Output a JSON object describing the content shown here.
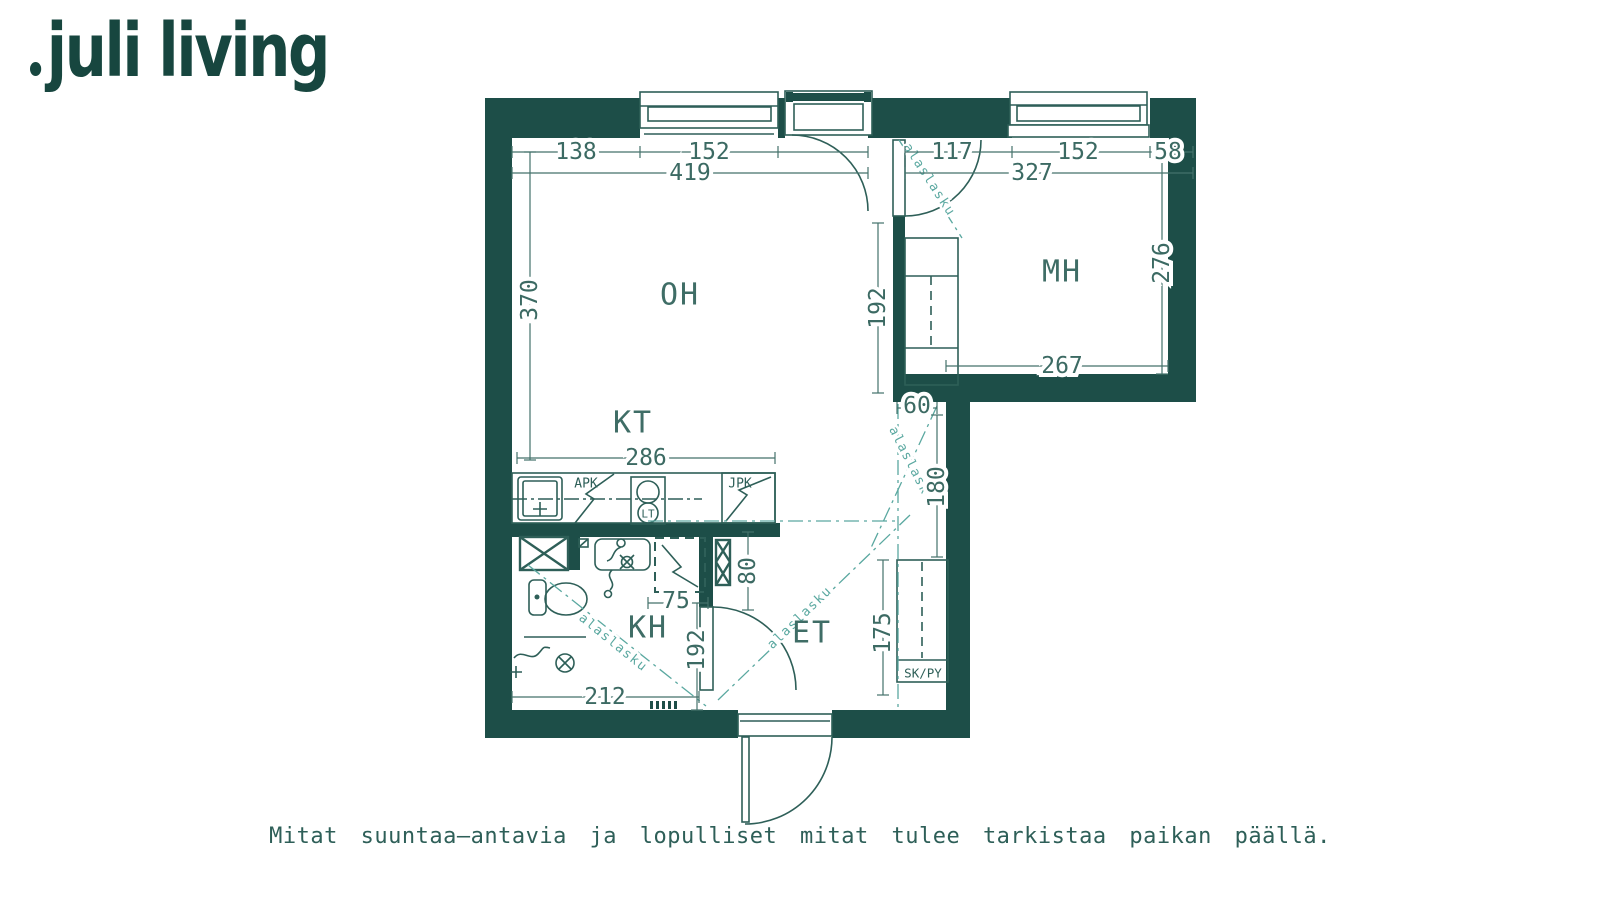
{
  "brand": {
    "name": "juli living"
  },
  "disclaimer": "Mitat suuntaa—antavia ja lopulliset mitat tulee tarkistaa paikan päällä.",
  "plan": {
    "rooms": {
      "living": "OH",
      "bedroom": "MH",
      "kitchen": "KT",
      "bathroom": "KH",
      "entry": "ET"
    },
    "fixtures": {
      "dishwasher": "APK",
      "fridge": "JPK",
      "lt_symbol": "LT",
      "closet": "SK/PY",
      "dropped_ceiling": "alaslasku"
    },
    "dims": {
      "oh_top_seg1": "138",
      "oh_top_seg2": "152",
      "oh_top_total": "419",
      "mh_top_seg1": "117",
      "mh_top_seg2": "152",
      "mh_top_seg3": "58",
      "mh_top_total": "327",
      "oh_left": "370",
      "oh_opening": "192",
      "mh_right": "276",
      "mh_bottom": "267",
      "nook_w": "60",
      "nook_h": "180",
      "kt_run": "286",
      "et_cab": "80",
      "kh_door": "75",
      "kh_h": "192",
      "kh_w": "212",
      "et_h": "175"
    }
  },
  "colors": {
    "wall": "#1d4e48",
    "line": "#2e5f58",
    "dimension": "#3c6a63",
    "dropped_ceiling": "#5aa8a0",
    "background": "#ffffff"
  }
}
